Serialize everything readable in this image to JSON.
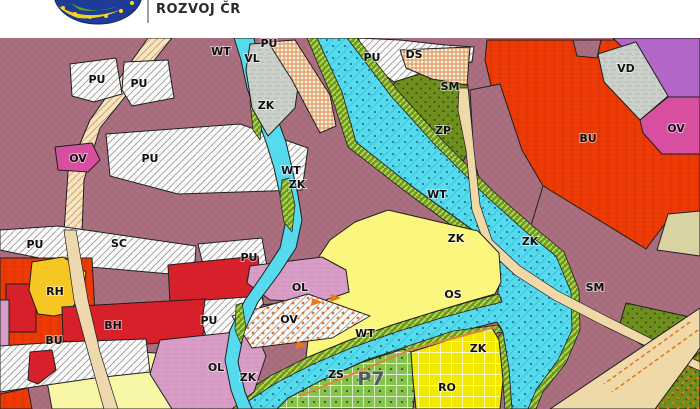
{
  "header": {
    "brand_text": "ROZVOJ ČR",
    "logo": "eu-stars-swoosh-logo"
  },
  "map": {
    "title": "zoning plan detail",
    "zone_labels": [
      {
        "text": "PU",
        "x": 269,
        "y": 47
      },
      {
        "text": "WT",
        "x": 221,
        "y": 55
      },
      {
        "text": "VL",
        "x": 252,
        "y": 62
      },
      {
        "text": "PU",
        "x": 372,
        "y": 61
      },
      {
        "text": "DS",
        "x": 414,
        "y": 58
      },
      {
        "text": "PU",
        "x": 97,
        "y": 83
      },
      {
        "text": "PU",
        "x": 139,
        "y": 87
      },
      {
        "text": "SM",
        "x": 450,
        "y": 90
      },
      {
        "text": "VD",
        "x": 626,
        "y": 72
      },
      {
        "text": "ZK",
        "x": 266,
        "y": 109
      },
      {
        "text": "OV",
        "x": 676,
        "y": 132
      },
      {
        "text": "ZP",
        "x": 443,
        "y": 134
      },
      {
        "text": "BU",
        "x": 588,
        "y": 142
      },
      {
        "text": "OV",
        "x": 78,
        "y": 162
      },
      {
        "text": "PU",
        "x": 150,
        "y": 162
      },
      {
        "text": "WT",
        "x": 291,
        "y": 174
      },
      {
        "text": "ZK",
        "x": 297,
        "y": 188
      },
      {
        "text": "WT",
        "x": 437,
        "y": 198
      },
      {
        "text": "ZK",
        "x": 456,
        "y": 242
      },
      {
        "text": "ZK",
        "x": 530,
        "y": 245
      },
      {
        "text": "PU",
        "x": 35,
        "y": 248
      },
      {
        "text": "SC",
        "x": 119,
        "y": 247
      },
      {
        "text": "PU",
        "x": 249,
        "y": 261
      },
      {
        "text": "SM",
        "x": 595,
        "y": 291
      },
      {
        "text": "RH",
        "x": 55,
        "y": 295
      },
      {
        "text": "OL",
        "x": 300,
        "y": 291
      },
      {
        "text": "OS",
        "x": 453,
        "y": 298
      },
      {
        "text": "OV",
        "x": 289,
        "y": 323
      },
      {
        "text": "PU",
        "x": 209,
        "y": 324
      },
      {
        "text": "BH",
        "x": 113,
        "y": 329
      },
      {
        "text": "WT",
        "x": 365,
        "y": 337
      },
      {
        "text": "BU",
        "x": 54,
        "y": 344
      },
      {
        "text": "ZK",
        "x": 478,
        "y": 352
      },
      {
        "text": "OL",
        "x": 216,
        "y": 371
      },
      {
        "text": "ZS",
        "x": 336,
        "y": 378
      },
      {
        "text": "ZK",
        "x": 248,
        "y": 381
      },
      {
        "text": "P7",
        "x": 371,
        "y": 385,
        "big": true
      },
      {
        "text": "RO",
        "x": 447,
        "y": 391
      }
    ],
    "zone_colors": {
      "mauve_sc_sm": "#ab7080",
      "water_cyan": "#55daee",
      "bank_green": "#6f9b23",
      "park_olive": "#6e8e1e",
      "red_bu": "#ee3a04",
      "red_bh": "#d7202a",
      "pink_ol": "#d89dc6",
      "magenta_ov": "#d94f9f",
      "purple": "#b266c8",
      "gray_vl_vd": "#ccd1cb",
      "yellow_os": "#fbf67d",
      "pale_yellow": "#f8f7a5",
      "gold_rh": "#f6c623",
      "grid_green_zs": "#85c24e",
      "grid_yellow_ro": "#f2e800",
      "road_tan": "#f0d9a8",
      "beige": "#d9d2a3",
      "hatch_white": "#fbfbf9"
    }
  }
}
